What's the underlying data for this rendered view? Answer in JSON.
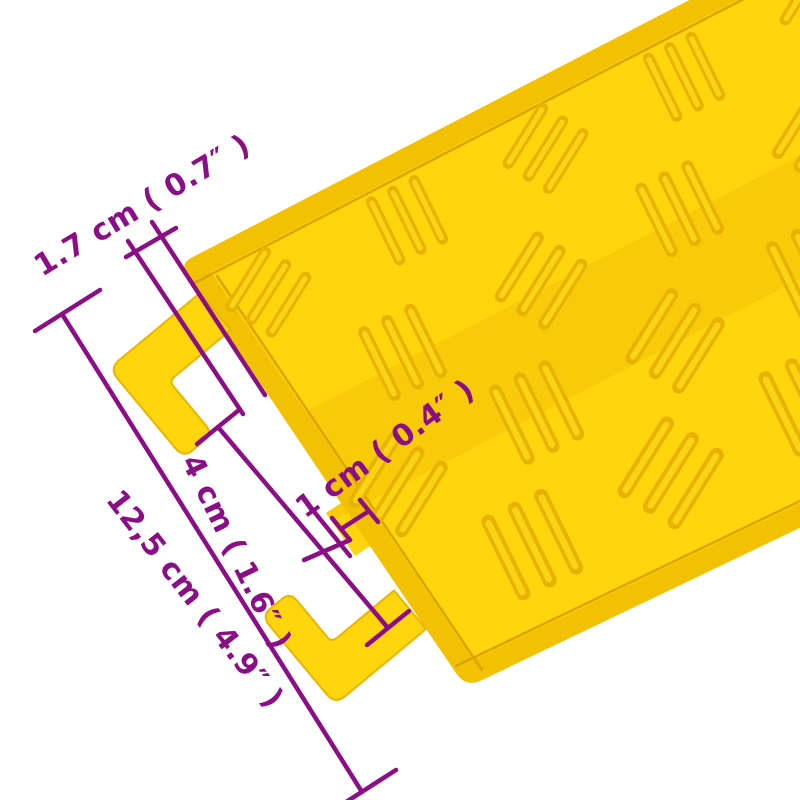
{
  "image": {
    "alt": "Yellow cable protector ramp section with checker tread pattern and connector hook tabs, annotated with purple measurement lines"
  },
  "dimensions": {
    "edge_thickness": {
      "label": "1.7 cm ( 0.7″ )"
    },
    "tab_spacing": {
      "label": "4 cm ( 1.6″ )"
    },
    "step_height": {
      "label": "1 cm ( 0.4″ )"
    },
    "end_width": {
      "label": "12,5 cm ( 4.9″ )"
    }
  },
  "colors": {
    "ramp_yellow": "#FFD60D",
    "ramp_shade": "#F3C104",
    "ramp_crease": "#DCA400",
    "annotation": "#8C0E86",
    "background": "#FFFFFF"
  }
}
